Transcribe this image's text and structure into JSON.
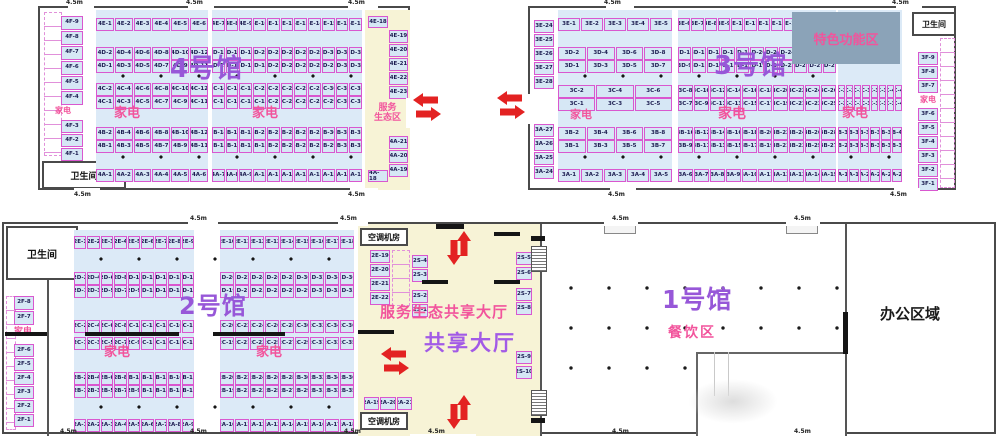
{
  "labels": {
    "dim": "4.5m",
    "restroom": "卫生间",
    "appliances": "家电",
    "ac_room": "空调机房",
    "featured_zone": "特色功能区",
    "service_eco_l1": "服务",
    "service_eco_l2": "生态区",
    "service_eco_hall": "服务生态共享大厅",
    "shared_hall": "共享大厅",
    "dining": "餐饮区",
    "office": "办公区域"
  },
  "colors": {
    "booth_border": "#d957cf",
    "booth_fill": "#d6e7f5",
    "block_fill": "#dceaf7",
    "hall_name_purple": "#9757d8",
    "pink_text": "#f2549c",
    "yellow_area": "#f7f3d6",
    "featured_fill": "#8ba3b8",
    "arrow_red": "#e32222",
    "wall": "#4a4a4a"
  },
  "halls": {
    "hall4": {
      "name": "4号馆",
      "f_col_top": [
        "4F-9",
        "4F-8",
        "4F-7",
        "4F-6",
        "4F-5",
        "4F-4"
      ],
      "f_col_bottom": [
        "4F-3",
        "4F-2",
        "4F-1"
      ],
      "left_block": [
        [
          "4E-1",
          "4E-2",
          "4E-3",
          "4E-4",
          "4E-5",
          "4E-6"
        ],
        [
          "4D-2",
          "4D-4",
          "4D-6",
          "4D-8",
          "4D-10",
          "4D-12"
        ],
        [
          "4D-1",
          "4D-3",
          "4D-5",
          "4D-7",
          "4D-9",
          "4D-11"
        ],
        [
          "4C-2",
          "4C-4",
          "4C-6",
          "4C-8",
          "4C-10",
          "4C-12"
        ],
        [
          "4C-1",
          "4C-3",
          "4C-5",
          "4C-7",
          "4C-9",
          "4C-11"
        ],
        [
          "4B-2",
          "4B-4",
          "4B-6",
          "4B-8",
          "4B-10",
          "4B-12"
        ],
        [
          "4B-1",
          "4B-3",
          "4B-5",
          "4B-7",
          "4B-9",
          "4B-11"
        ],
        [
          "4A-1",
          "4A-2",
          "4A-3",
          "4A-4",
          "4A-5",
          "4A-6"
        ]
      ],
      "right_block": [
        [
          "4E-7",
          "4E-8",
          "4E-9",
          "4E-10",
          "4E-11",
          "4E-12",
          "4E-13",
          "4E-14",
          "4E-15",
          "4E-16",
          "4E-17"
        ],
        [
          "4D-14",
          "4D-16",
          "4D-18",
          "4D-20",
          "4D-22",
          "4D-24",
          "4D-26",
          "4D-28",
          "4D-30",
          "4D-32",
          "4D-34"
        ],
        [
          "4D-13",
          "4D-15",
          "4D-17",
          "4D-19",
          "4D-21",
          "4D-23",
          "4D-25",
          "4D-27",
          "4D-29",
          "4D-31",
          "4D-33"
        ],
        [
          "4C-14",
          "4C-16",
          "4C-18",
          "4C-20",
          "4C-22",
          "4C-24",
          "4C-26",
          "4C-28",
          "4C-30",
          "4C-32",
          "4C-34"
        ],
        [
          "4C-13",
          "4C-15",
          "4C-17",
          "4C-19",
          "4C-21",
          "4C-23",
          "4C-25",
          "4C-27",
          "4C-29",
          "4C-31",
          "4C-33"
        ],
        [
          "4B-14",
          "4B-16",
          "4B-18",
          "4B-20",
          "4B-22",
          "4B-24",
          "4B-26",
          "4B-28",
          "4B-30",
          "4B-32",
          "4B-34"
        ],
        [
          "4B-13",
          "4B-15",
          "4B-17",
          "4B-19",
          "4B-21",
          "4B-23",
          "4B-25",
          "4B-27",
          "4B-29",
          "4B-31",
          "4B-33"
        ],
        [
          "4A-7",
          "4A-8",
          "4A-9",
          "4A-10",
          "4A-11",
          "4A-12",
          "4A-13",
          "4A-14",
          "4A-15",
          "4A-16",
          "4A-17"
        ]
      ],
      "strip": {
        "top_cell": "4E-18",
        "top_col": [
          "4E-19",
          "4E-20",
          "4E-21",
          "4E-22",
          "4E-23"
        ],
        "bottom_col": [
          "4A-21",
          "4A-20",
          "4A-19"
        ],
        "bottom_cell": "4A-18"
      }
    },
    "hall3": {
      "name": "3号馆",
      "left_col_top": [
        "3E-24",
        "3E-25",
        "3E-26",
        "3E-27",
        "3E-28"
      ],
      "left_col_bottom": [
        "3A-27",
        "3A-26",
        "3A-25",
        "3A-24"
      ],
      "left_block": [
        [
          "3E-1",
          "3E-2",
          "3E-3",
          "3E-4",
          "3E-5"
        ],
        [
          "3D-2",
          "3D-4",
          "3D-6",
          "3D-8"
        ],
        [
          "3D-1",
          "3D-3",
          "3D-5",
          "3D-7"
        ],
        [
          "3C-2",
          "3C-4",
          "3C-6"
        ],
        [
          "3C-1",
          "3C-3",
          "3C-5"
        ],
        [
          "3B-2",
          "3B-4",
          "3B-6",
          "3B-8"
        ],
        [
          "3B-1",
          "3B-3",
          "3B-5",
          "3B-7"
        ],
        [
          "3A-1",
          "3A-2",
          "3A-3",
          "3A-4",
          "3A-5"
        ]
      ],
      "mid_block": [
        [
          "3E-6",
          "3E-7",
          "3E-8",
          "3E-9",
          "3E-10",
          "3E-11",
          "3E-12",
          "3E-13",
          "3E-14",
          "3E-15",
          "3E-16",
          "3E-17"
        ],
        [
          "3D-10",
          "3D-12",
          "3D-14",
          "3D-16",
          "3D-18",
          "3D-20",
          "3D-22",
          "3D-24",
          "3D-26",
          "3D-28",
          "3D-30"
        ],
        [
          "3D-9",
          "3D-11",
          "3D-13",
          "3D-15",
          "3D-17",
          "3D-19",
          "3D-21",
          "3D-23",
          "3D-25",
          "3D-27",
          "3D-29"
        ],
        [
          "3C-8",
          "3C-10",
          "3C-12",
          "3C-14",
          "3C-16",
          "3C-18",
          "3C-20",
          "3C-22",
          "3C-24",
          "3C-26"
        ],
        [
          "3C-7",
          "3C-9",
          "3C-11",
          "3C-13",
          "3C-15",
          "3C-17",
          "3C-19",
          "3C-21",
          "3C-23",
          "3C-25"
        ],
        [
          "3B-10",
          "3B-12",
          "3B-14",
          "3B-16",
          "3B-18",
          "3B-20",
          "3B-22",
          "3B-24",
          "3B-26",
          "3B-28"
        ],
        [
          "3B-9",
          "3B-11",
          "3B-13",
          "3B-15",
          "3B-17",
          "3B-19",
          "3B-21",
          "3B-23",
          "3B-25",
          "3B-27"
        ],
        [
          "3A-6",
          "3A-7",
          "3A-8",
          "3A-9",
          "3A-10",
          "3A-11",
          "3A-12",
          "3A-13",
          "3A-14",
          "3A-15"
        ]
      ],
      "right_block": [
        [
          "3C-28",
          "3C-30",
          "3C-32",
          "3C-34",
          "3C-36",
          "3C-38",
          "3C-40",
          "3C-42"
        ],
        [
          "3C-27",
          "3C-29",
          "3C-31",
          "3C-33",
          "3C-35",
          "3C-37",
          "3C-39",
          "3C-41"
        ],
        [
          "3B-30",
          "3B-32",
          "3B-34",
          "3B-36",
          "3B-38",
          "3B-40"
        ],
        [
          "3B-29",
          "3B-31",
          "3B-33",
          "3B-35",
          "3B-37",
          "3B-39"
        ],
        [
          "3A-18",
          "3A-19",
          "3A-20",
          "3A-21",
          "3A-22",
          "3A-23"
        ]
      ],
      "f_col_top": [
        "3F-9",
        "3F-8",
        "3F-7"
      ],
      "f_col_bottom": [
        "3F-6",
        "3F-5",
        "3F-4",
        "3F-3",
        "3F-2",
        "3F-1"
      ]
    },
    "hall2": {
      "name": "2号馆",
      "f_col_top": [
        "2F-8",
        "2F-7"
      ],
      "f_col_bottom": [
        "2F-6",
        "2F-5",
        "2F-4",
        "2F-3",
        "2F-2",
        "2F-1"
      ],
      "left_block": [
        [
          "2E-1",
          "2E-2",
          "2E-3",
          "2E-4",
          "2E-5",
          "2E-6",
          "2E-7",
          "2E-8",
          "2E-9"
        ],
        [
          "2D-2",
          "2D-4",
          "2D-6",
          "2D-8",
          "2D-10",
          "2D-12",
          "2D-14",
          "2D-16",
          "2D-18"
        ],
        [
          "2D-1",
          "2D-3",
          "2D-5",
          "2D-7",
          "2D-9",
          "2D-11",
          "2D-13",
          "2D-15",
          "2D-17"
        ],
        [
          "2C-2",
          "2C-4",
          "2C-6",
          "2C-8",
          "2C-10",
          "2C-12",
          "2C-14",
          "2C-16",
          "2C-18"
        ],
        [
          "2C-1",
          "2C-3",
          "2C-5",
          "2C-7",
          "2C-9",
          "2C-11",
          "2C-13",
          "2C-15",
          "2C-17"
        ],
        [
          "2B-2",
          "2B-4",
          "2B-6",
          "2B-8",
          "2B-10",
          "2B-12",
          "2B-14",
          "2B-16",
          "2B-18"
        ],
        [
          "2B-1",
          "2B-3",
          "2B-5",
          "2B-7",
          "2B-9",
          "2B-11",
          "2B-13",
          "2B-15",
          "2B-17"
        ],
        [
          "2A-1",
          "2A-2",
          "2A-3",
          "2A-4",
          "2A-5",
          "2A-6",
          "2A-7",
          "2A-8",
          "2A-9"
        ]
      ],
      "right_block": [
        [
          "2E-10",
          "2E-11",
          "2E-12",
          "2E-13",
          "2E-14",
          "2E-15",
          "2E-16",
          "2E-17",
          "2E-18"
        ],
        [
          "2D-20",
          "2D-22",
          "2D-24",
          "2D-26",
          "2D-28",
          "2D-30",
          "2D-32",
          "2D-34",
          "2D-36"
        ],
        [
          "2D-19",
          "2D-21",
          "2D-23",
          "2D-25",
          "2D-27",
          "2D-29",
          "2D-31",
          "2D-33",
          "2D-35"
        ],
        [
          "2C-20",
          "2C-22",
          "2C-24",
          "2C-26",
          "2C-28",
          "2C-30",
          "2C-32",
          "2C-34",
          "2C-36"
        ],
        [
          "2C-19",
          "2C-21",
          "2C-23",
          "2C-25",
          "2C-27",
          "2C-29",
          "2C-31",
          "2C-33",
          "2C-35"
        ],
        [
          "2B-20",
          "2B-22",
          "2B-24",
          "2B-26",
          "2B-28",
          "2B-30",
          "2B-32",
          "2B-34",
          "2B-36"
        ],
        [
          "2B-19",
          "2B-21",
          "2B-23",
          "2B-25",
          "2B-27",
          "2B-29",
          "2B-31",
          "2B-33",
          "2B-35"
        ],
        [
          "2A-10",
          "2A-11",
          "2A-12",
          "2A-13",
          "2A-14",
          "2A-15",
          "2A-16",
          "2A-17",
          "2A-18"
        ]
      ],
      "strip_e_col": [
        "2E-19",
        "2E-20",
        "2E-21",
        "2E-22"
      ],
      "strip_s_col": [
        "2S-4",
        "2S-3",
        "2S-2",
        "2S-1"
      ],
      "strip_a_row": [
        [
          "2A-19",
          "2A-20",
          "2A-21"
        ]
      ],
      "shared_s_col": [
        "2S-5",
        "2S-6",
        "2S-7",
        "2S-8",
        "2S-9",
        "2S-10"
      ]
    },
    "hall1": {
      "name": "1号馆"
    }
  }
}
